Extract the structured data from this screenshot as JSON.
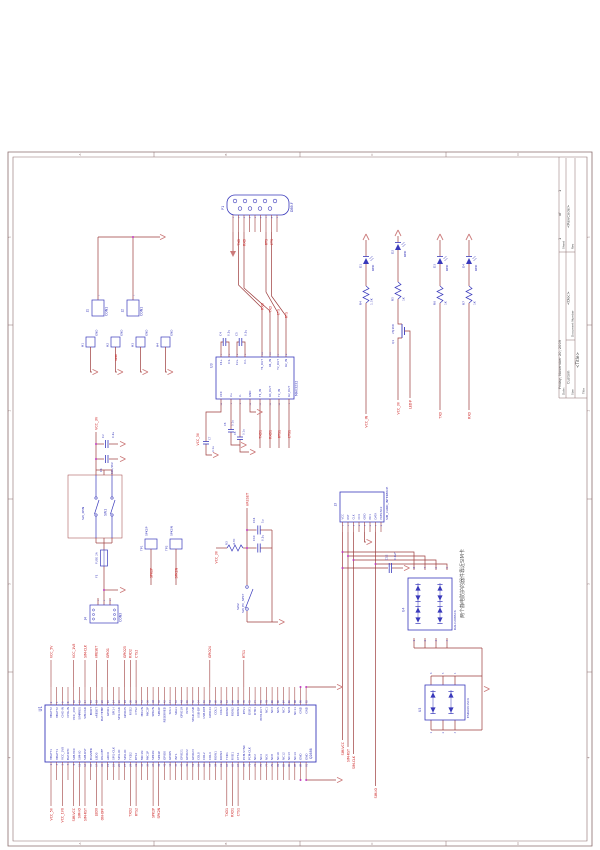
{
  "colors": {
    "frame": "#8a6d6d",
    "wire": "#9c3b3b",
    "part": "#3939bb",
    "net": "#cc2222",
    "dot": "#c03cc0",
    "arrow": "#cc7a7a",
    "note": "#555555",
    "titletext": "#444444"
  },
  "title_block": {
    "title_label": "Title",
    "title": "<Title>",
    "size_label": "Size",
    "size": "Custom",
    "doc_label": "Document Number",
    "doc": "<Doc>",
    "rev_label": "Rev",
    "rev": "<RevCode>",
    "date_label": "Date:",
    "date": "Friday, November 20, 2009",
    "sheet_label": "Sheet",
    "sheet": "1",
    "of_label": "of",
    "total": "1"
  },
  "zones": {
    "letters": [
      "A",
      "B",
      "C",
      "D"
    ],
    "numbers": [
      "1",
      "2",
      "3",
      "4"
    ]
  },
  "db9": {
    "ref": "P1",
    "value": "DB9-F",
    "pins": [
      "1",
      "2",
      "3",
      "4",
      "5",
      "6",
      "7",
      "8",
      "9"
    ],
    "nets": [
      "TXD",
      "RXD",
      "RTS",
      "CTS"
    ],
    "nets_u3": [
      "RXD",
      "TXD",
      "CTS",
      "RTS"
    ]
  },
  "u3": {
    "ref": "U3",
    "value": "MAX3232",
    "top_pins": [
      [
        "1",
        "C1+"
      ],
      [
        "3",
        "C1-"
      ],
      [
        "4",
        "C2+"
      ],
      [
        "5",
        "C2-"
      ],
      [
        "14",
        "T1_OUT"
      ],
      [
        "13",
        "R1_IN"
      ],
      [
        "7",
        "T2_OUT"
      ],
      [
        "8",
        "R2_IN"
      ]
    ],
    "bottom_pins": [
      [
        "16",
        "VCC"
      ],
      [
        "2",
        "V+"
      ],
      [
        "6",
        "V-"
      ],
      [
        "15",
        "GND"
      ],
      [
        "11",
        "T1_IN"
      ],
      [
        "12",
        "R1_OUT"
      ],
      [
        "10",
        "T2_IN"
      ],
      [
        "9",
        "R2_OUT"
      ]
    ],
    "bottom_nets": [
      "TXD1",
      "RXD1",
      "RTS1",
      "CTS1"
    ],
    "vcc_net": "VCC_3V",
    "caps": {
      "c4": [
        "C4",
        "0.1u"
      ],
      "c5": [
        "C5",
        "0.1u"
      ],
      "c6": [
        "C6",
        "0.1u"
      ],
      "c8": [
        "C8",
        "0.1u"
      ],
      "c7": [
        "C7",
        "0.1u"
      ]
    }
  },
  "leds": {
    "items": [
      {
        "ref": "D1",
        "value": "RED",
        "r_ref": "R4",
        "r_value": "1.5K",
        "net": "VCC_IN"
      },
      {
        "ref": "D2",
        "value": "RED",
        "r_ref": "R5",
        "r_value": "1K",
        "net": "VCC_3V"
      },
      {
        "ref": "D3",
        "value": "RED",
        "r_ref": "R6",
        "r_value": "1K",
        "net": "TXD"
      },
      {
        "ref": "D4",
        "value": "RED",
        "r_ref": "R7",
        "r_value": "1K",
        "net": "RXD"
      }
    ],
    "q1": {
      "ref": "Q1",
      "value": "2SJ168",
      "gate_net": "LED#"
    }
  },
  "left": {
    "j1": [
      "J1",
      "CON1"
    ],
    "j2": [
      "J2",
      "CON1"
    ],
    "pin1": "1",
    "holes": [
      "H1",
      "H2",
      "H3",
      "H4"
    ],
    "hole_pad": "GND",
    "hole_net": "GND"
  },
  "power": {
    "rail": "VCC_3V",
    "c2": [
      "C2",
      "0.1u"
    ],
    "c1": [
      "C1",
      "10u/16V"
    ],
    "sw1": [
      "SW1",
      "SW_4PIN"
    ],
    "f1": [
      "F1",
      "FUSE 2A"
    ],
    "j4": [
      "J4",
      "CON3"
    ],
    "j4_pins": [
      "1",
      "2",
      "3"
    ]
  },
  "tps": [
    [
      "TP1",
      "SPK2P"
    ],
    [
      "TP2",
      "SPK2N"
    ]
  ],
  "reset": {
    "rail": "VCC_3V",
    "r3": [
      "R3",
      "4.7K"
    ],
    "c10": [
      "C10",
      "0.1u"
    ],
    "c11": [
      "C11",
      "1u"
    ],
    "sw2": [
      "SW2",
      "SW_PC_SPST"
    ],
    "net": "nRESET"
  },
  "sim": {
    "ref": "J3",
    "value": "SIM_CARD_INTERFACE",
    "pins": [
      [
        "1",
        "VCC"
      ],
      [
        "2",
        "RST"
      ],
      [
        "3",
        "CLK"
      ],
      [
        "4",
        "CC4"
      ],
      [
        "5",
        "GND"
      ],
      [
        "6",
        "NC1"
      ],
      [
        "7",
        "DATA"
      ],
      [
        "8",
        "PRES:NC2"
      ]
    ],
    "c12": [
      "C12",
      "0.1uF"
    ],
    "u4": {
      "ref": "U4",
      "value": "DALC208SC6",
      "top_n": [
        "8",
        "7",
        "6",
        "5"
      ],
      "bot_n": [
        "1",
        "2",
        "3",
        "4"
      ]
    },
    "u5": {
      "ref": "U5",
      "value": "ESDA6V1SC6",
      "top_n": [
        "6",
        "5",
        "4"
      ],
      "bot_n": [
        "1",
        "2",
        "3"
      ]
    },
    "note": "两个静电防护的器件靠近SIM卡",
    "nets": [
      "SIM-VCC",
      "SIM-RST",
      "SIM-CLK",
      "SIM-IO"
    ]
  },
  "u1": {
    "ref": "U1",
    "value": "Q2686",
    "top_pins": [
      "VBATT2",
      "VBATT2",
      "CHG-IN",
      "CHG-IN",
      "VCC_2V8",
      "SIMPRES",
      "SIM-CLK",
      "BOOT",
      "nRESET",
      "BAT-TEMP",
      "GPIO1",
      "SPI1-I",
      "SPI2-CLK",
      "GPIO25",
      "RXD2",
      "CTS2",
      "MIC2N",
      "MIC2P",
      "SPK2N",
      "SPK2P",
      "RESERVED",
      "SCL1",
      "SDA1",
      "GPIO19",
      "INT0",
      "VPAD-USB",
      "USB-DP",
      "USB-DM",
      "GPIO24",
      "COL1",
      "COL3",
      "ROW0",
      "ROW2",
      "ROW4",
      "RTS1",
      "DSR1",
      "DTR1",
      "PCM-OUT",
      "NC1",
      "NC3",
      "NC5",
      "NC7",
      "NC9",
      "NC11",
      "GND",
      "GND"
    ],
    "bottom_pins": [
      "VBATT1",
      "VBATT1",
      "VCC_1V8",
      "BAT-RTC",
      "SIM-VCC",
      "SIM-IO",
      "SIM-RST",
      "BUZZER",
      "LED0",
      "ON-OFF",
      "ADC0",
      "SPI1-CLK",
      "SPI1-IO",
      "SPI2-IO",
      "TXD2",
      "RTS2",
      "MIC1N",
      "MIC1P",
      "SPK1N",
      "SPK1P",
      "GPIO0",
      "GPIO5",
      "INT1",
      "GPIO21",
      "GPIO22",
      "GPIO23",
      "COL0",
      "COL2",
      "COL4",
      "ROW1",
      "ROW3",
      "TXD1",
      "RXD1",
      "CTS1",
      "PCM-SYNC",
      "PCM-CLK",
      "NC2",
      "NC4",
      "NC6",
      "NC8",
      "NC10",
      "NC12",
      "NC13",
      "NC14",
      "GND",
      "GND"
    ],
    "top_nets": [
      [
        "VCC_5V",
        0
      ],
      [
        "VCC_1V8",
        4
      ],
      [
        "SIM-CLK",
        6
      ],
      [
        "nRESET",
        8
      ],
      [
        "GPIO1",
        10
      ],
      [
        "GPIO25",
        13
      ],
      [
        "RXD2",
        14
      ],
      [
        "CTS2",
        15
      ],
      [
        "GPIO24",
        28
      ],
      [
        "RTS1",
        34
      ]
    ],
    "bottom_nets": [
      [
        "VCC_5V",
        0
      ],
      [
        "VCC_1V8",
        2
      ],
      [
        "SIM-VCC",
        4
      ],
      [
        "SIM-IO",
        5
      ],
      [
        "SIM-RST",
        6
      ],
      [
        "LED0",
        8
      ],
      [
        "ON-OFF",
        9
      ],
      [
        "TXD2",
        14
      ],
      [
        "RTS2",
        15
      ],
      [
        "SPK2P",
        18
      ],
      [
        "SPK2N",
        19
      ],
      [
        "TXD1",
        31
      ],
      [
        "RXD1",
        32
      ],
      [
        "CTS1",
        33
      ]
    ]
  }
}
